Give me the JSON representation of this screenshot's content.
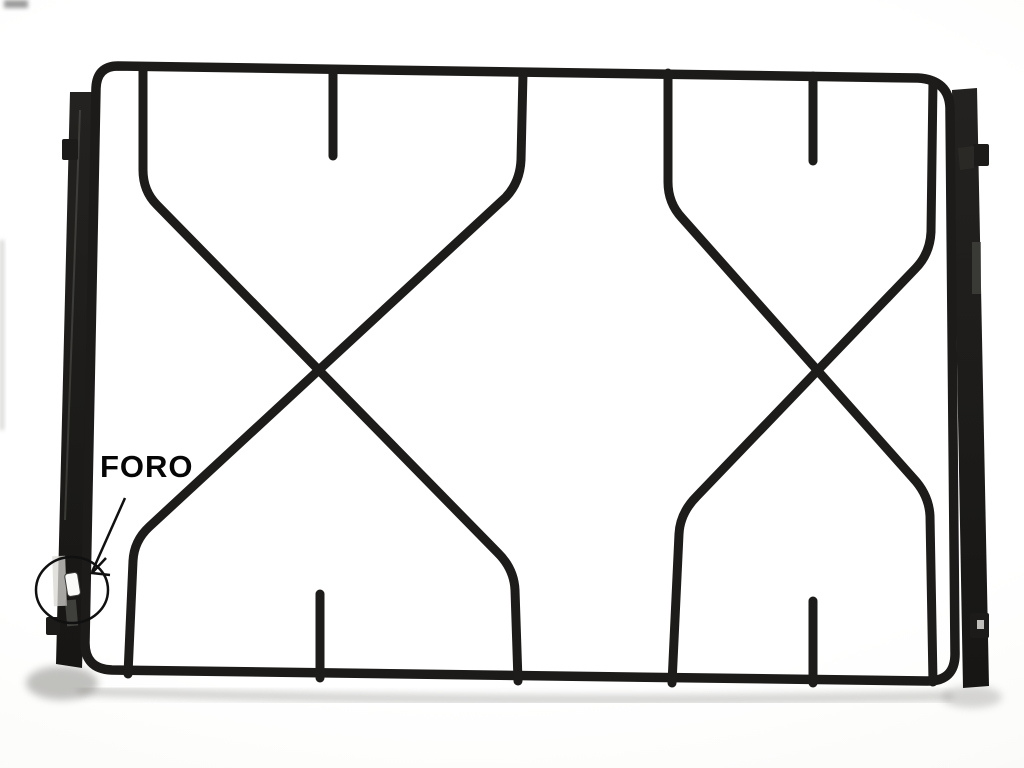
{
  "scene": {
    "description": "Photograph of a black enamelled two-burner gas stove pan-support grate on a white background",
    "object": "pan-support-grate"
  },
  "annotation": {
    "label": "FORO",
    "color": "#060606",
    "target": "small hole in the left side rail, circled with an arrow pointing to it"
  },
  "colors": {
    "grate": "#1c1b19",
    "background": "#fbfbf9",
    "shadow": "#a3a29f"
  }
}
